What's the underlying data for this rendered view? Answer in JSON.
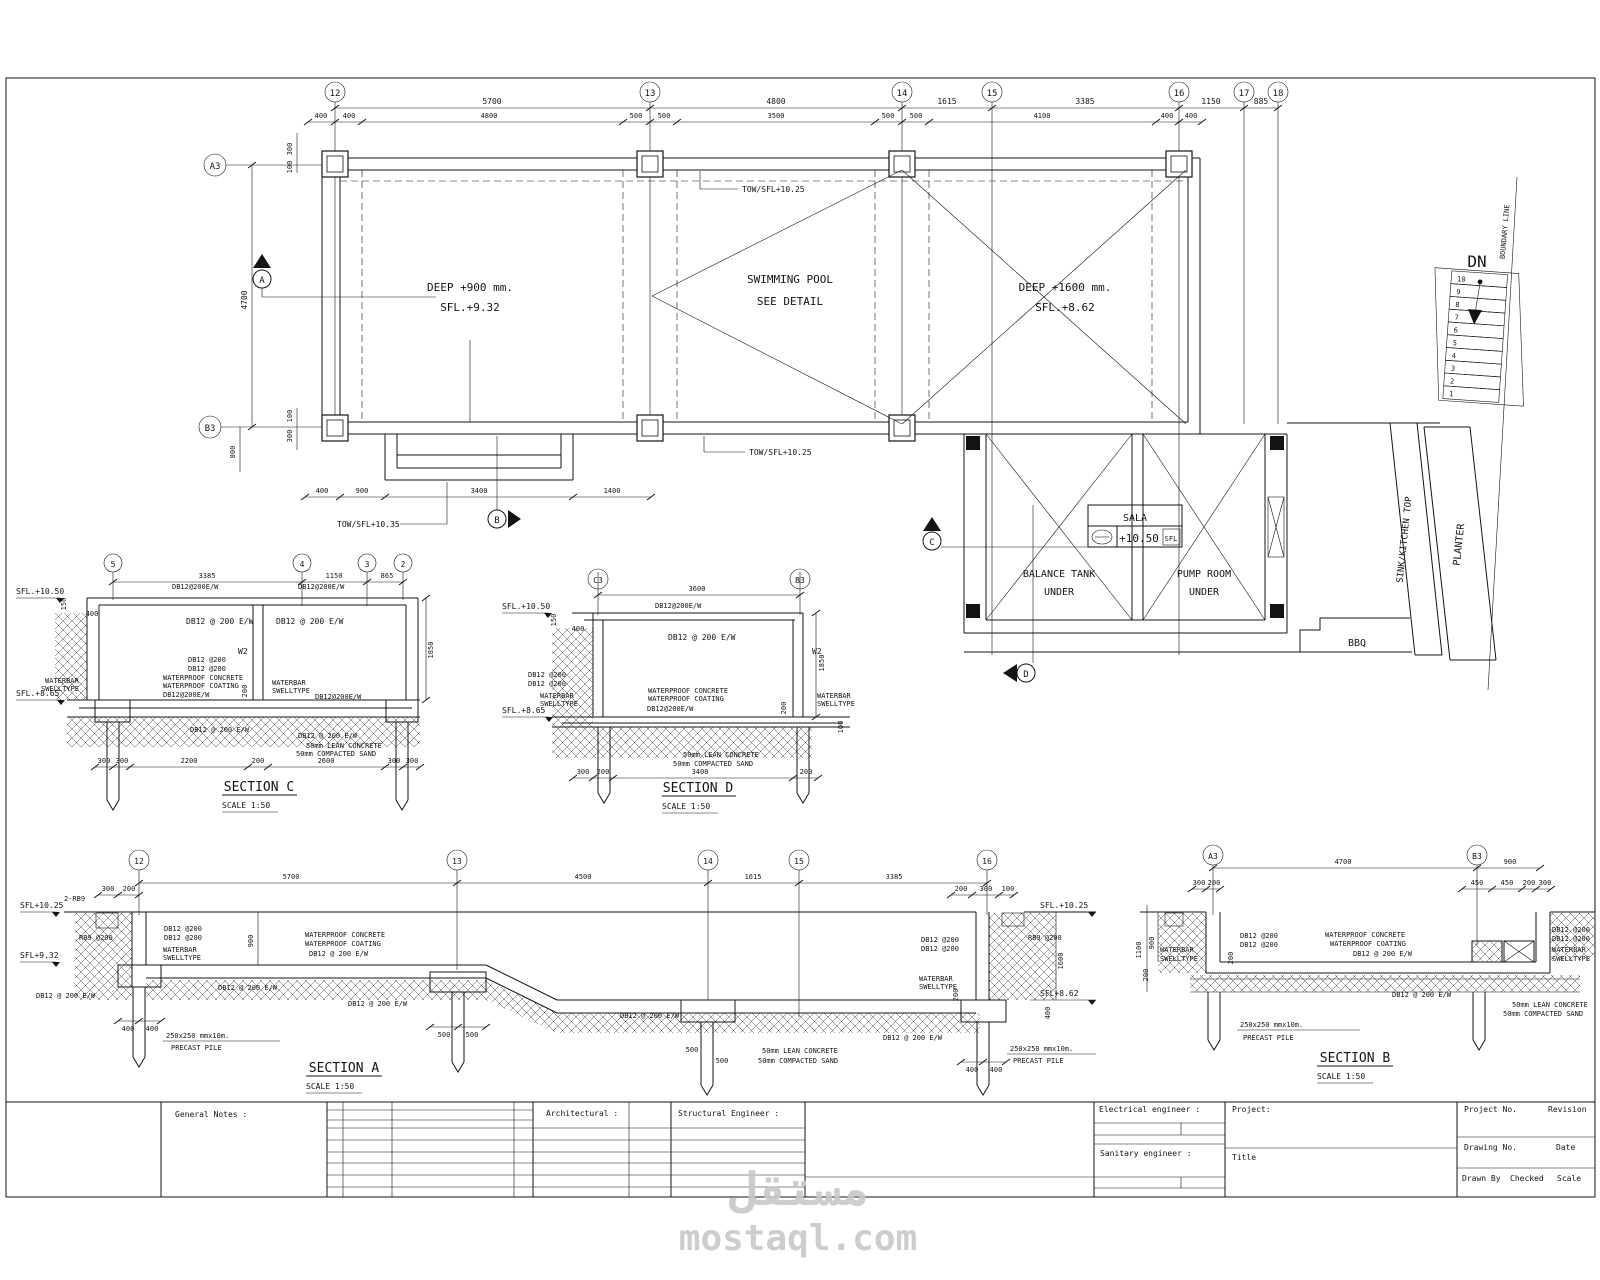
{
  "sheet": {
    "watermark_ar": "مستقل",
    "watermark_domain": "mostaql.com"
  },
  "common": {
    "db12_200_ew": "DB12 @ 200 E/W",
    "db12_200ew_c": "DB12@200E/W",
    "db12_200": "DB12 @200",
    "rb9_200": "RB9 @200",
    "rb9_2": "2-RB9",
    "waterbar": "WATERBAR",
    "swelltype": "SWELLTYPE",
    "wp_concrete": "WATERPROOF CONCRETE",
    "wp_coating": "WATERPROOF COATING",
    "lean": "50mm LEAN CONCRETE",
    "sand": "50mm COMPACTED SAND",
    "pile_dim": "250x250 mmx10m.",
    "pile": "PRECAST PILE",
    "scale150": "SCALE 1:50",
    "w2": "W2"
  },
  "plan": {
    "grids": [
      "12",
      "13",
      "14",
      "15",
      "16",
      "17",
      "18"
    ],
    "grid_a3": "A3",
    "grid_b3": "B3",
    "dim_row1": [
      "5700",
      "4800",
      "1615",
      "3385",
      "1150",
      "885"
    ],
    "dim_row2": [
      "400",
      "400",
      "4800",
      "500",
      "500",
      "3500",
      "500",
      "500",
      "4100",
      "400",
      "400"
    ],
    "dim_left": {
      "d300t": "300",
      "d100t": "100",
      "d4700": "4700",
      "d100b": "100",
      "d300b": "300",
      "d800": "800"
    },
    "dim_bottom": [
      "400",
      "900",
      "3400",
      "1400"
    ],
    "pool1_l1": "DEEP +900 mm.",
    "pool1_l2": "SFL.+9.32",
    "pool_c1": "SWIMMING POOL",
    "pool_c2": "SEE DETAIL",
    "pool2_l1": "DEEP +1600 mm.",
    "pool2_l2": "SFL.+8.62",
    "tow1": "TOW/SFL+10.25",
    "tow2": "TOW/SFL+10.25",
    "tow3": "TOW/SFL+10.35",
    "sala": "SALA",
    "sala_lvl": "+10.50",
    "sala_sfl": "SFL",
    "bt1": "BALANCE TANK",
    "bt2": "UNDER",
    "pr1": "PUMP ROOM",
    "pr2": "UNDER",
    "bbq": "BBQ",
    "sink": "SINK/KITCHEN TOP",
    "planter": "PLANTER",
    "dn": "DN",
    "boundary": "BOUNDARY LINE",
    "stairs": [
      "1",
      "2",
      "3",
      "4",
      "5",
      "6",
      "7",
      "8",
      "9",
      "10"
    ],
    "mk": {
      "a": "A",
      "b": "B",
      "c": "C",
      "d": "D"
    }
  },
  "secC": {
    "title": "SECTION  C",
    "grids": [
      "5",
      "4",
      "3",
      "2"
    ],
    "dims_top": [
      "3385",
      "1150",
      "865"
    ],
    "sfl_top": "SFL.+10.50",
    "sfl_bot": "SFL.+8.65",
    "d150": "150",
    "d400": "400",
    "d1850": "1850",
    "d200v": "200",
    "dims_bot": [
      "300",
      "300",
      "2200",
      "200",
      "2600",
      "300",
      "300"
    ]
  },
  "secD": {
    "title": "SECTION  D",
    "grids": [
      "C3",
      "B3"
    ],
    "d3600": "3600",
    "sfl_top": "SFL.+10.50",
    "sfl_bot": "SFL.+8.65",
    "d150": "150",
    "d400": "400",
    "d1850": "1850",
    "d200v": "200",
    "d100v": "100",
    "dims_bot": [
      "300",
      "200",
      "3400",
      "200"
    ]
  },
  "secA": {
    "title": "SECTION  A",
    "grids": [
      "12",
      "13",
      "14",
      "15",
      "16"
    ],
    "dims_top": [
      "5700",
      "4500",
      "1615",
      "3385"
    ],
    "dims_l": [
      "300",
      "200"
    ],
    "dims_r": [
      "200",
      "300",
      "100"
    ],
    "sfl1": "SFL+10.25",
    "sfl2": "SFL+9.32",
    "sfl3": "SFL.+10.25",
    "sfl4": "SFL+8.62",
    "d900": "900",
    "d1600": "1600",
    "d400": "400",
    "d200": "200",
    "p400": [
      "400",
      "400"
    ],
    "p500a": [
      "500",
      "500"
    ],
    "p500b": [
      "500",
      "500"
    ],
    "p400r": [
      "400",
      "400"
    ]
  },
  "secB": {
    "title": "SECTION  B",
    "grids": [
      "A3",
      "B3"
    ],
    "dims_top": [
      "4700",
      "900"
    ],
    "dims_l": [
      "300",
      "200"
    ],
    "dims_r": [
      "450",
      "450",
      "200",
      "300"
    ],
    "d1100": "1100",
    "d900": "900",
    "d200l": "200",
    "d200m": "200"
  },
  "tb": {
    "general_notes": "General Notes :",
    "architectural": "Architectural :",
    "structural": "Structural Engineer :",
    "electrical": "Electrical engineer :",
    "sanitary": "Sanitary engineer :",
    "project": "Project:",
    "title": "Title",
    "project_no": "Project No.",
    "revision": "Revision",
    "drawing_no": "Drawing No.",
    "date": "Date",
    "drawn_by": "Drawn By",
    "checked": "Checked",
    "scale": "Scale"
  }
}
